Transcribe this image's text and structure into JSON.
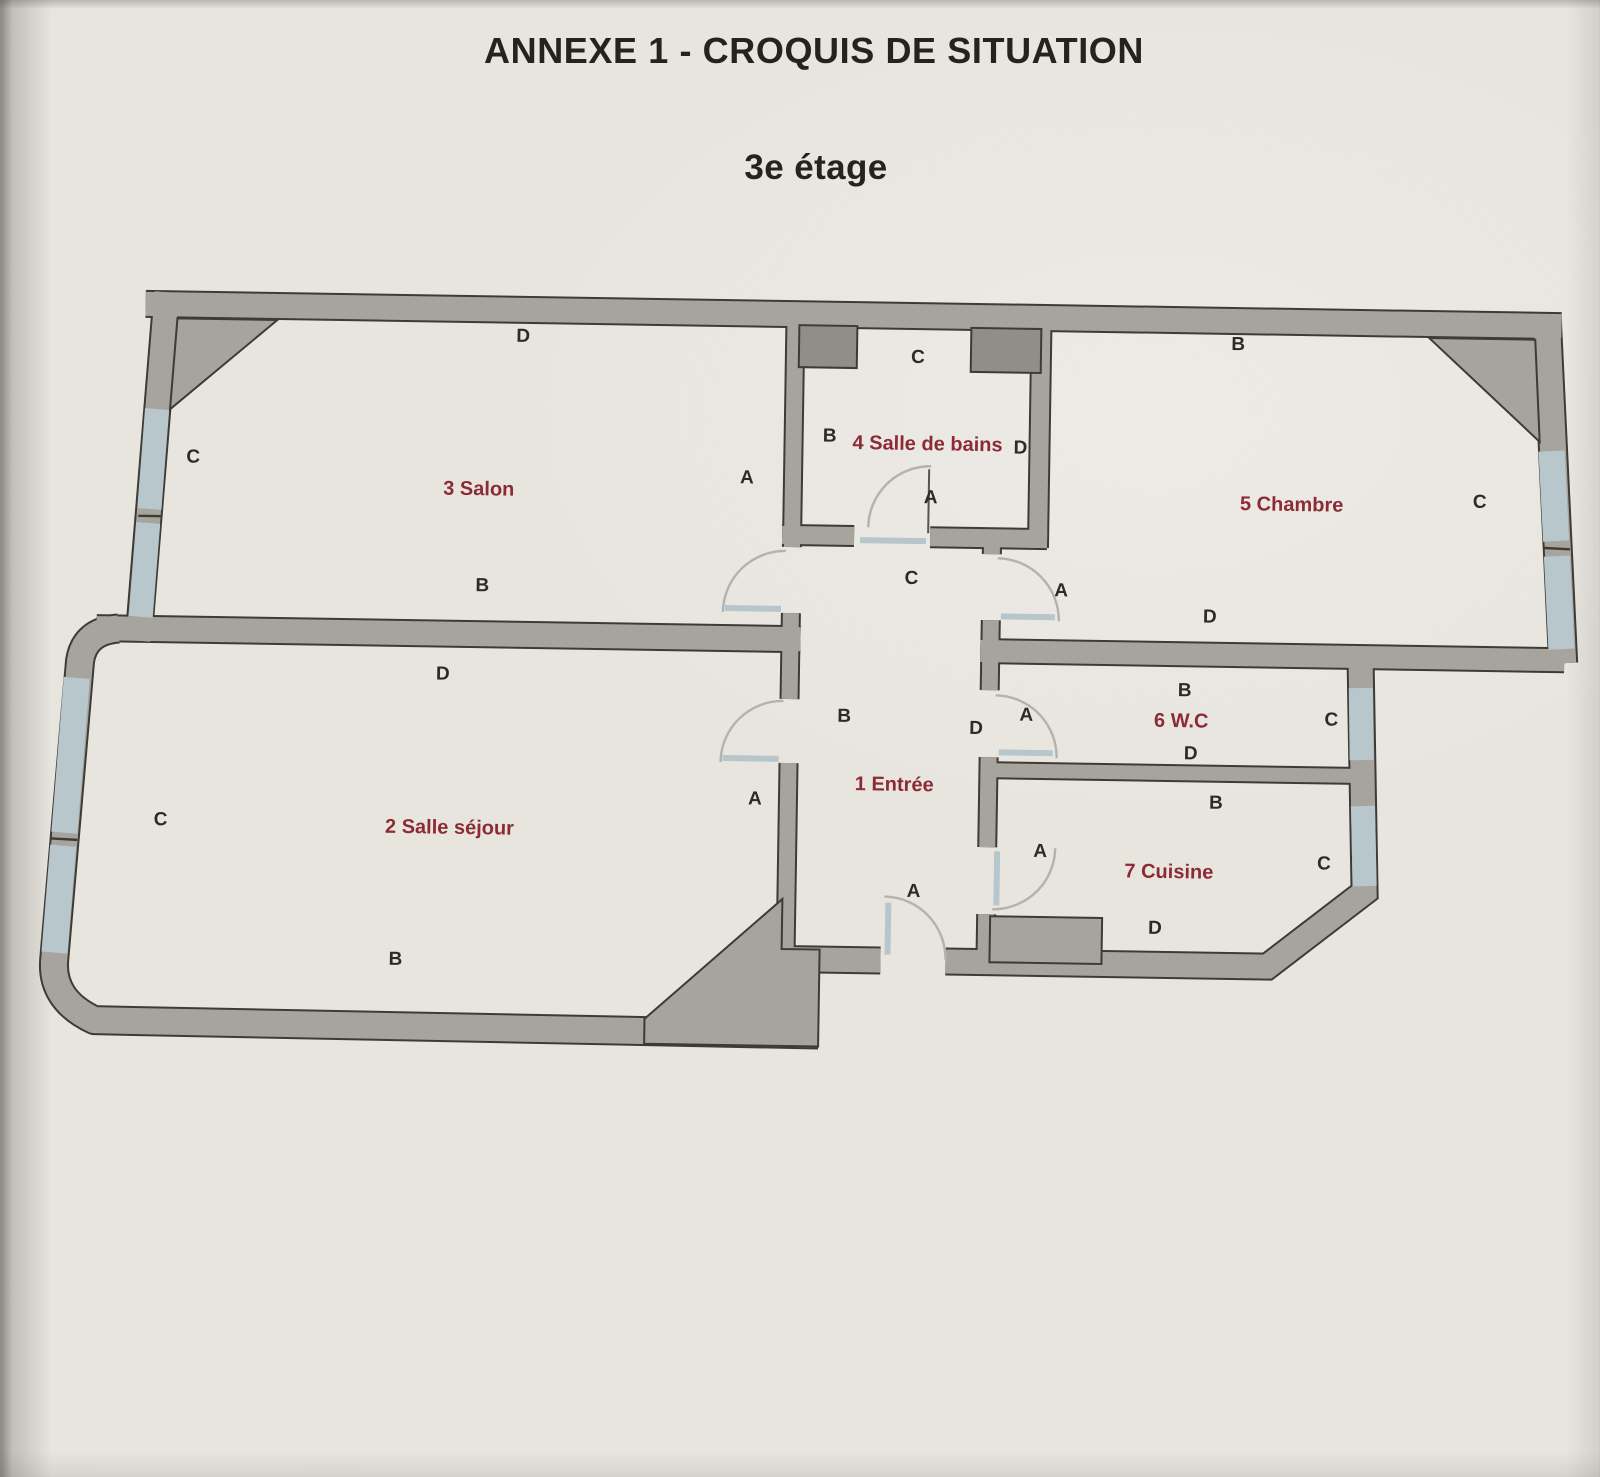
{
  "document": {
    "title": "ANNEXE 1 - CROQUIS DE SITUATION",
    "subtitle": "3e étage"
  },
  "floor_plan": {
    "rooms": [
      {
        "name": "1 Entrée",
        "letters": {
          "top": "C",
          "left": "B",
          "right": "D",
          "bottom": "A"
        }
      },
      {
        "name": "2 Salle séjour",
        "letters": {
          "top": "D",
          "left": "C",
          "right": "A",
          "bottom": "B"
        }
      },
      {
        "name": "3 Salon",
        "letters": {
          "top": "D",
          "left": "C",
          "right": "A",
          "bottom": "B"
        }
      },
      {
        "name": "4 Salle de bains",
        "letters": {
          "top": "C",
          "left": "B",
          "right": "D",
          "bottom": "A"
        }
      },
      {
        "name": "5 Chambre",
        "letters": {
          "top": "B",
          "door": "A",
          "right": "C",
          "bottom": "D"
        }
      },
      {
        "name": "6 W.C",
        "letters": {
          "top": "B",
          "left": "A",
          "right": "C",
          "bottom": "D"
        }
      },
      {
        "name": "7 Cuisine",
        "letters": {
          "top": "B",
          "left": "A",
          "right": "C",
          "bottom": "D"
        }
      }
    ],
    "colors": {
      "wall_fill": "#a7a49d",
      "wall_dark": "#918e87",
      "wall_outline": "#3e3b36",
      "window": "#b7c7cc",
      "room_label": "#8c2b35",
      "wall_letter": "#2d2b27"
    }
  }
}
